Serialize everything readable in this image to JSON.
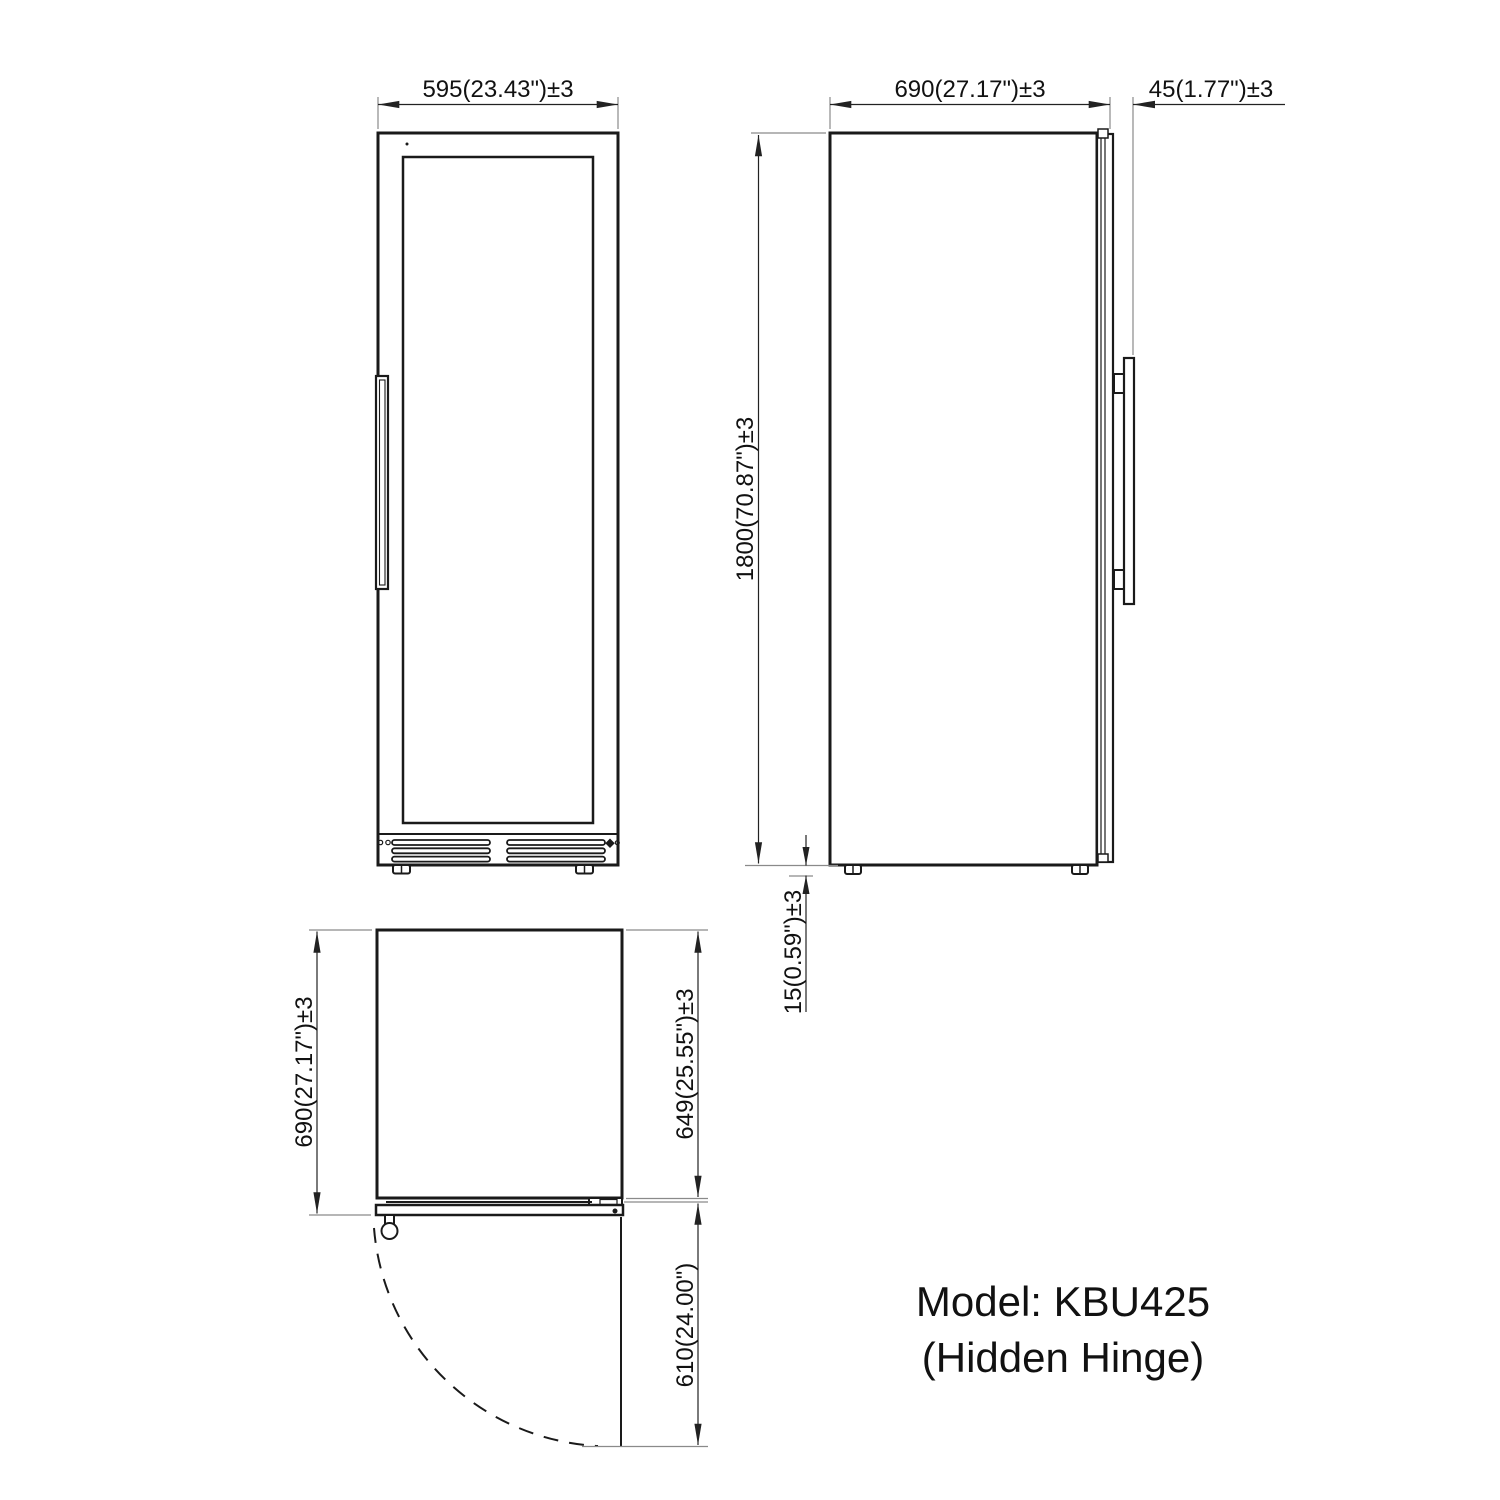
{
  "dims": {
    "front_width": "595(23.43\")±3",
    "side_depth": "690(27.17\")±3",
    "side_handle": "45(1.77\")±3",
    "side_height": "1800(70.87\")±3",
    "side_foot": "15(0.59\")±3",
    "top_depth_total": "690(27.17\")±3",
    "top_depth_body": "649(25.55\")±3",
    "top_door_swing": "610(24.00\")"
  },
  "model": {
    "line1": "Model: KBU425",
    "line2": "(Hidden Hinge)"
  }
}
